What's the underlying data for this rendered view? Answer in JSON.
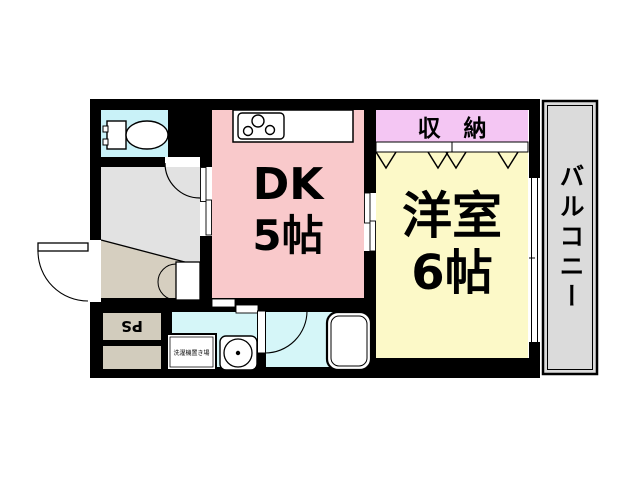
{
  "floor_plan": {
    "rooms": {
      "dk": {
        "label": "DK",
        "size": "5帖",
        "color": "#F9C9CB"
      },
      "western_room": {
        "label": "洋室",
        "size": "6帖",
        "color": "#FCF9C8"
      },
      "closet": {
        "label": "収　納",
        "color": "#F4C6F3"
      },
      "balcony": {
        "label": "バルコニー",
        "color": "#DBDBDB"
      },
      "pipe_space": {
        "label": "PS",
        "color": "#D2CCBD"
      },
      "laundry_space": {
        "label": "洗濯機置き場"
      },
      "toilet": {
        "color": "#C9F2F8"
      },
      "hallway": {
        "color": "#E2E2E2"
      },
      "entrance": {
        "color": "#D6CFC0"
      },
      "washroom": {
        "color": "#D5F6F8"
      },
      "bathroom": {
        "color": "#D5F6F8"
      }
    },
    "wall_color": "#000000",
    "icons": {
      "toilet": "toilet-icon",
      "stove": "stove-icon",
      "bathtub": "bathtub-icon",
      "washing_machine": "washer-icon",
      "window": "window-icon",
      "door": "door-swing-icon"
    }
  }
}
